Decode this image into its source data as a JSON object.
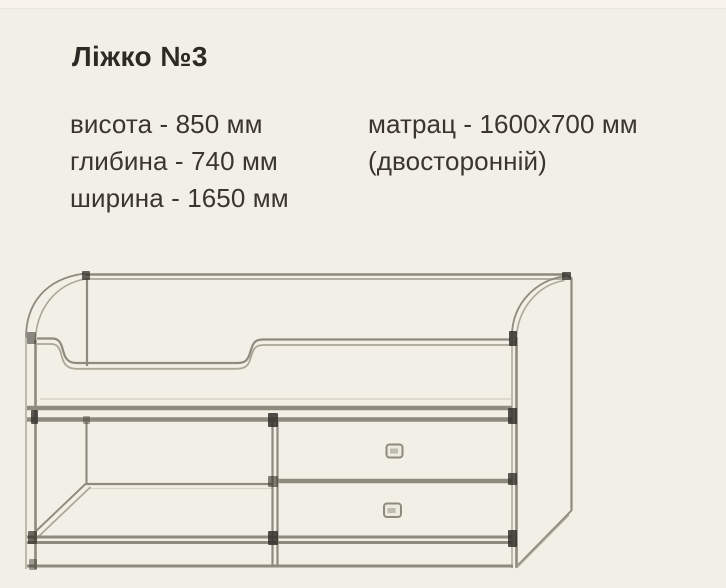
{
  "header": {
    "title": "Ліжко №3"
  },
  "specs": {
    "left": [
      "висота - 850 мм",
      "глибина - 740 мм",
      "ширина - 1650 мм"
    ],
    "right": [
      "матрац - 1600х700 мм",
      "(двосторонній)"
    ]
  },
  "colors": {
    "bg": "#f2efe7",
    "top-strip": "#f9f3ed",
    "text": "#3a362f",
    "title": "#2d2a25",
    "line": "#8e8a7e",
    "line-soft": "#aba797",
    "line-faint": "#d8d4c7",
    "dark": "#33302a",
    "handle-fill": "#edeadf"
  }
}
